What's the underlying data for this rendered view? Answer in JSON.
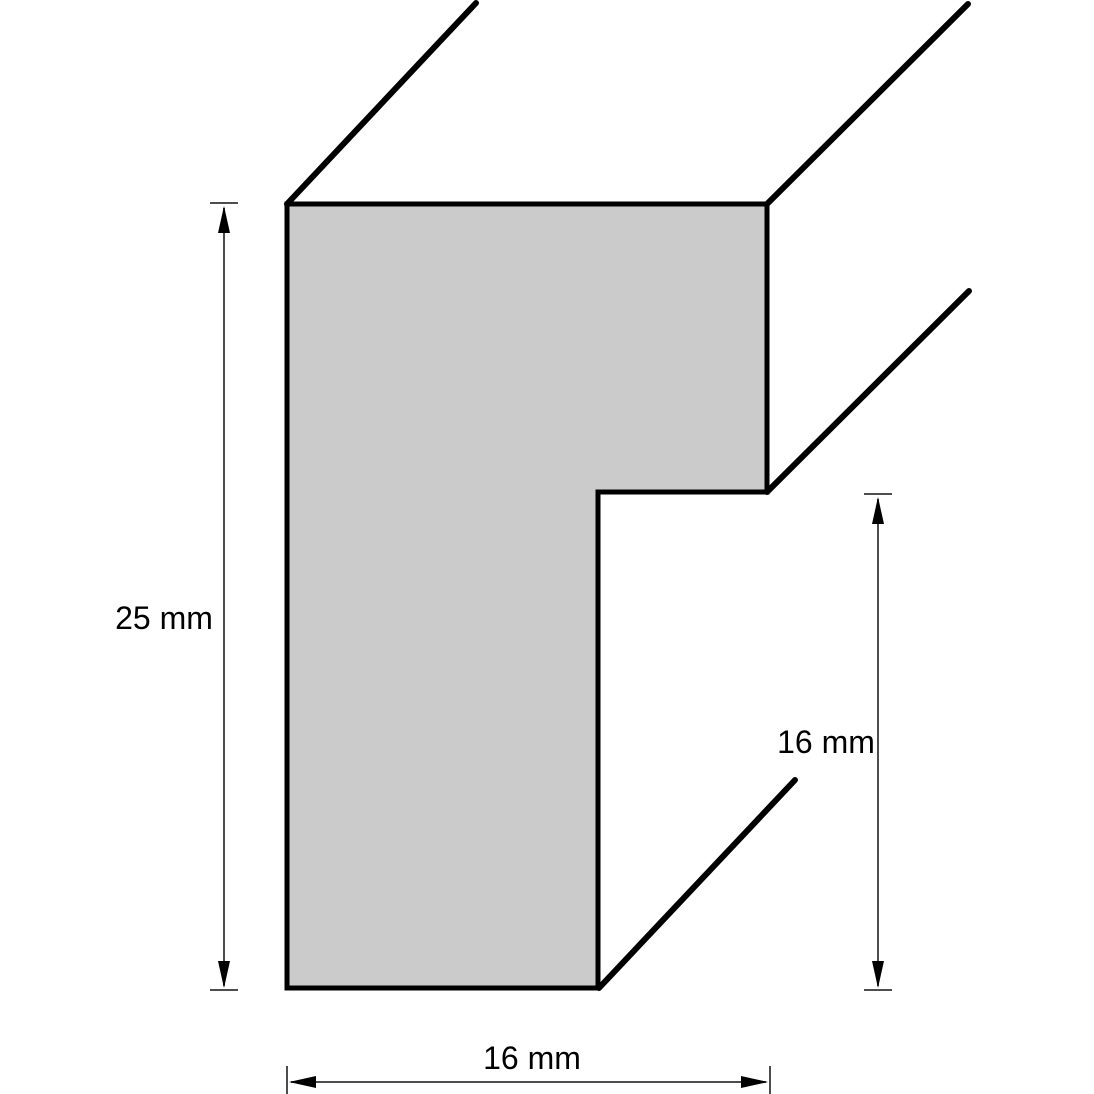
{
  "diagram": {
    "type": "technical-drawing",
    "subject": "frame moulding cross-section profile",
    "colors": {
      "profile_fill": "#cbcbcb",
      "outline": "#000000",
      "dimension_line": "#4d4d4d",
      "arrowhead": "#000000",
      "background": "#ffffff",
      "text": "#000000"
    },
    "dimensions": {
      "height": {
        "label": "25 mm",
        "value": 25,
        "unit": "mm",
        "side": "left",
        "orientation": "vertical"
      },
      "rabbet": {
        "label": "16 mm",
        "value": 16,
        "unit": "mm",
        "side": "right",
        "orientation": "vertical"
      },
      "width": {
        "label": "16 mm",
        "value": 16,
        "unit": "mm",
        "side": "bottom",
        "orientation": "horizontal"
      }
    }
  }
}
